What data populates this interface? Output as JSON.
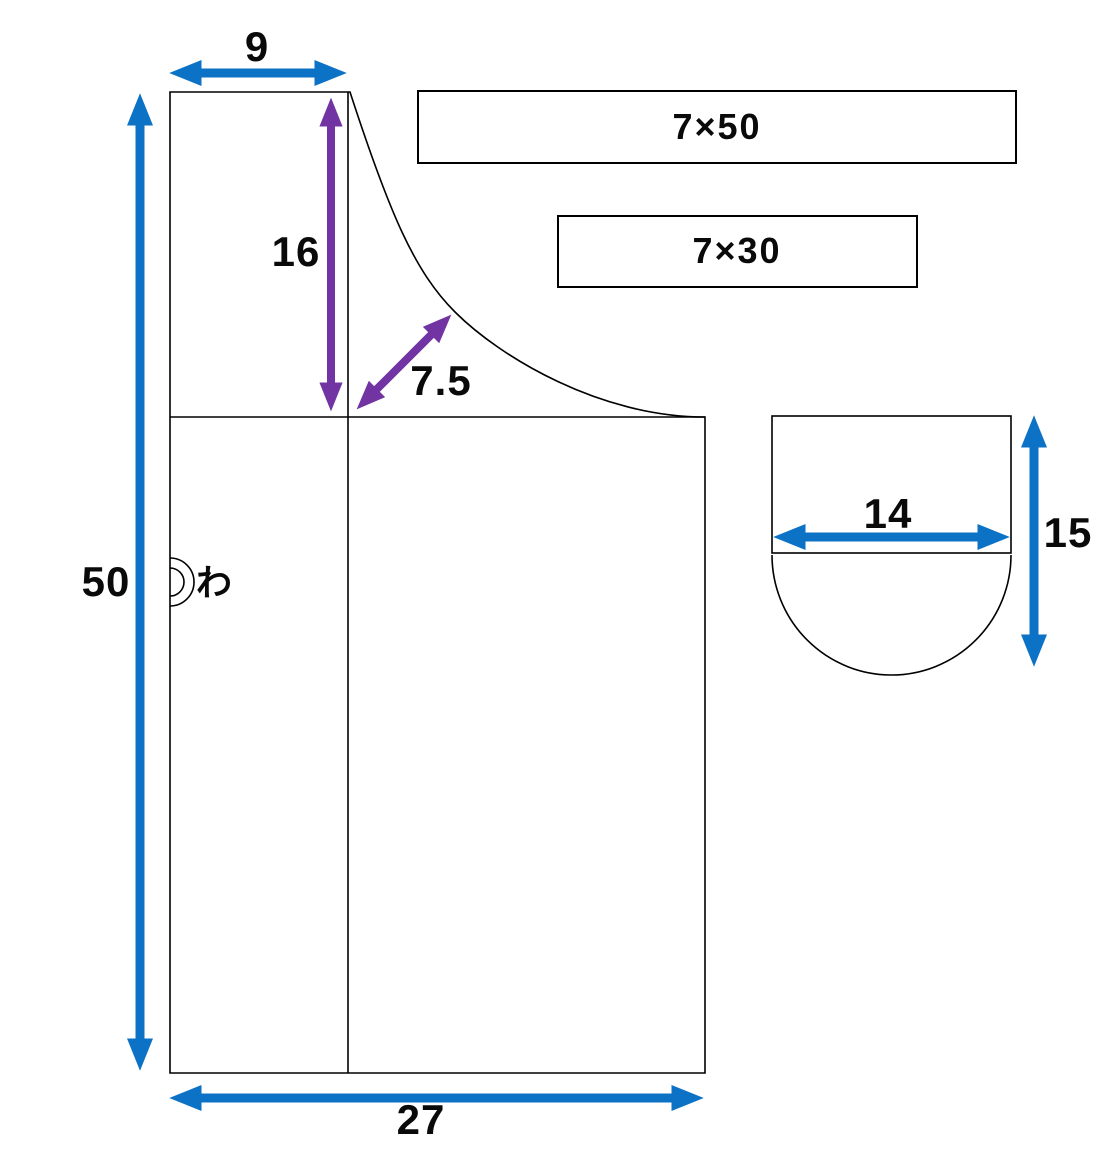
{
  "diagram": {
    "kind": "sewing-pattern",
    "pieces": {
      "main_body": {
        "fold_mark": "わ",
        "dimensions": {
          "top_width": "9",
          "neck_depth": "16",
          "neck_curve": "7.5",
          "side_height": "50",
          "bottom_width": "27"
        }
      },
      "strap_long": {
        "label": "7×50"
      },
      "strap_short": {
        "label": "7×30"
      },
      "pocket": {
        "dimensions": {
          "width": "14",
          "height": "15"
        }
      }
    }
  },
  "colors": {
    "dimension_arrow_blue": "#0C72C6",
    "dimension_arrow_purple": "#7233A3",
    "outline": "#000000",
    "background": "#FFFFFF"
  }
}
